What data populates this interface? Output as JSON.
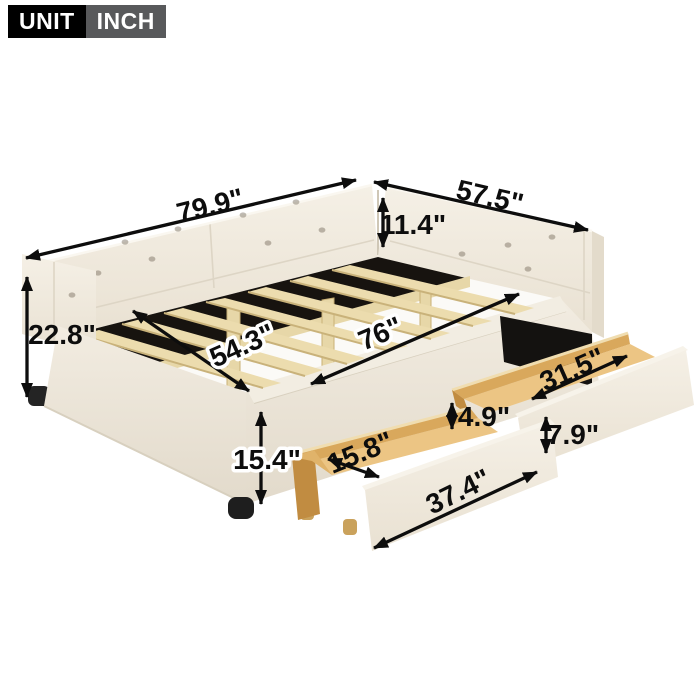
{
  "badge": {
    "unit_label": "UNIT",
    "unit_value": "INCH"
  },
  "dimensions": {
    "length": "79.9\"",
    "width": "57.5\"",
    "back_height": "11.4\"",
    "side_height": "22.8\"",
    "inner_width": "54.3\"",
    "inner_length": "76\"",
    "base_height": "15.4\"",
    "drawer_inner_length": "31.5\"",
    "drawer_depth": "4.9\"",
    "drawer_front_height": "7.9\"",
    "drawer_width": "15.8\"",
    "drawer_front_length": "37.4\""
  },
  "colors": {
    "badge_black": "#000000",
    "badge_gray": "#58595b",
    "arrow": "#0d0d0d",
    "upholstery": "#f1ebe0",
    "upholstery_shade": "#e7dfd1",
    "slat_wood": "#ecdcae",
    "fabric_black": "#17130f",
    "drawer_wood_wall": "#d9a85c",
    "drawer_wood_floor": "#ecc584",
    "drawer_wood_dark": "#c18c41"
  }
}
